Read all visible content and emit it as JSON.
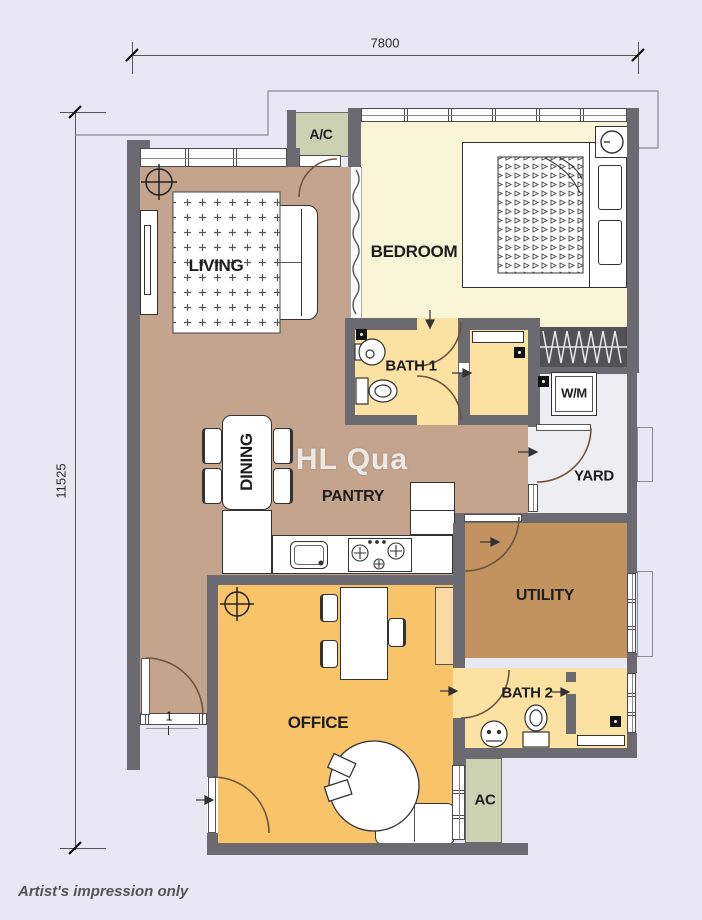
{
  "watermark": "HL Qua",
  "footnote": "Artist's impression only",
  "dimensions": {
    "top": "7800",
    "left": "11525"
  },
  "rooms": {
    "living": "LIVING",
    "bedroom": "BEDROOM",
    "bath1": "BATH 1",
    "dining": "DINING",
    "pantry": "PANTRY",
    "yard": "YARD",
    "wm": "W/M",
    "utility": "UTILITY",
    "office": "OFFICE",
    "bath2": "BATH 2",
    "ac_upper": "A/C",
    "ac_lower": "AC"
  },
  "annotations": {
    "entry_door_number": "1"
  },
  "colors": {
    "bg": "#e9e7f3",
    "wall": "#6b6a70",
    "floorLiving": "#c4a48d",
    "floorBedroom": "#f9f5d7",
    "floorBath": "#fbe2a2",
    "floorUtility": "#c2935f",
    "floorOffice": "#f8c369",
    "floorYard": "#eeedf2",
    "ledge": "#cbd1b2",
    "wardrobe": "#515156",
    "watermark": "rgba(255,255,255,0.8)"
  }
}
